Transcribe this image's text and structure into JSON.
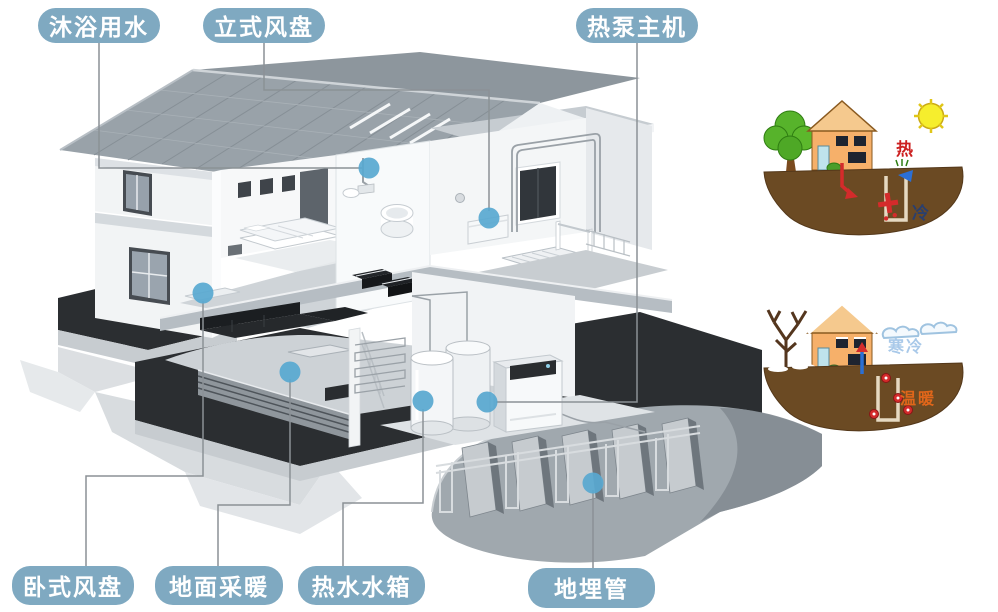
{
  "callouts": {
    "bathing_water": {
      "label": "沐浴用水"
    },
    "vertical_fan_coil": {
      "label": "立式风盘"
    },
    "heat_pump_main_unit": {
      "label": "热泵主机"
    },
    "horizontal_fan_coil": {
      "label": "卧式风盘"
    },
    "floor_heating": {
      "label": "地面采暖"
    },
    "hot_water_tank": {
      "label": "热水水箱"
    },
    "ground_buried_pipe": {
      "label": "地埋管"
    }
  },
  "side_diagrams": {
    "summer": {
      "hot": "热",
      "cold": "冷"
    },
    "winter": {
      "cold": "寒冷",
      "warm": "温暖"
    }
  },
  "colors": {
    "callout_bg": "#7fa9c1",
    "callout_text": "#ffffff",
    "leader_line": "#8b9196",
    "marker_dot": "#58a8d0",
    "summer_hot_text": "#cc2020",
    "summer_cold_text": "#2a3f6e",
    "winter_cold_text": "#a9c9e9",
    "winter_warm_text": "#e0661a",
    "cartoon_ground": "#6b4a23",
    "cartoon_house_wall": "#f6b06a"
  }
}
